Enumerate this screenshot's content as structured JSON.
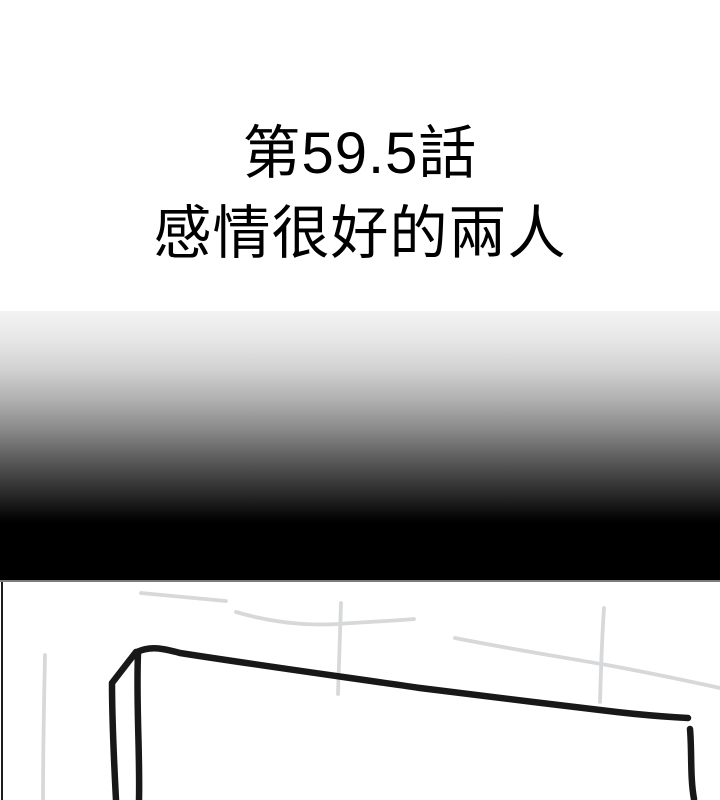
{
  "title": {
    "line1": "第59.5話",
    "line2": "感情很好的兩人"
  },
  "colors": {
    "paper": "#ffffff",
    "ink-text": "#000000",
    "ink": "#181818",
    "pencil": "#d6d8d9",
    "rule-gray": "#7d7d7d",
    "border-ink": "#1c1c1c",
    "gradient-top": "#f3f3f3",
    "gradient-bottom": "#000000"
  }
}
